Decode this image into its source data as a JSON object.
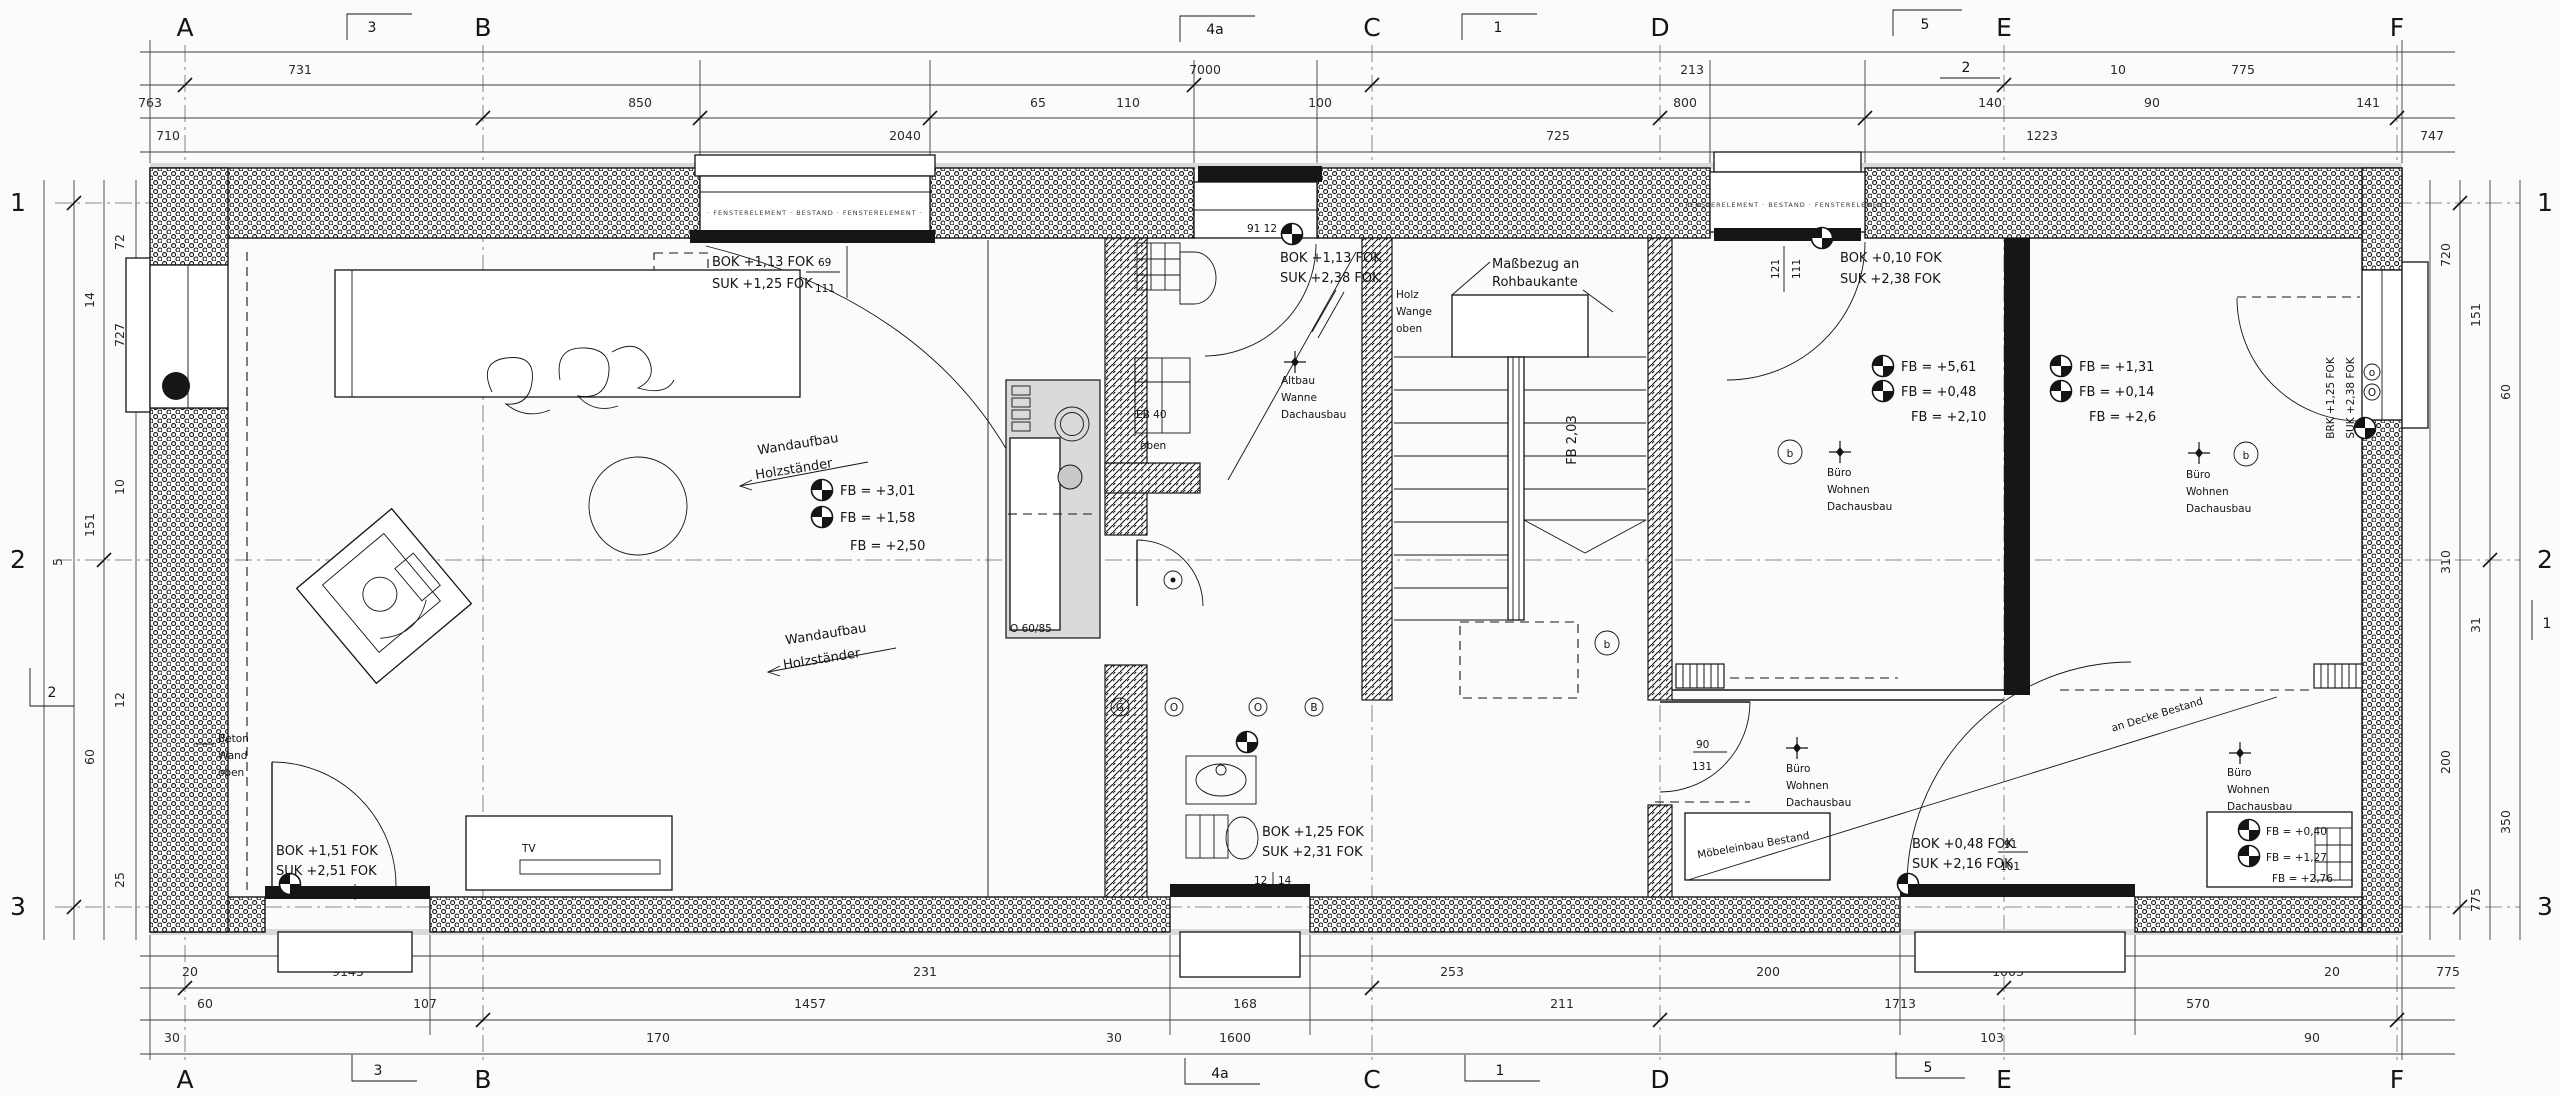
{
  "grid": {
    "cols": [
      "A",
      "B",
      "C",
      "D",
      "E",
      "F"
    ],
    "rows": [
      "1",
      "2",
      "3"
    ]
  },
  "flags": {
    "a": "3",
    "b": "4a",
    "c": "1",
    "d": "5",
    "e": "2",
    "left": "2",
    "right": "1"
  },
  "dims": {
    "top_a": [
      "731",
      "7000",
      "213",
      "10",
      "775"
    ],
    "top_b": [
      "763",
      "850",
      "65",
      "110",
      "100",
      "800",
      "140",
      "90",
      "141"
    ],
    "top_c": [
      "710",
      "2040",
      "725",
      "1223",
      "747"
    ],
    "bot_a": [
      "20",
      "9145",
      "231",
      "253",
      "200",
      "1003",
      "20",
      "775"
    ],
    "bot_b": [
      "60",
      "107",
      "1457",
      "168",
      "211",
      "1713",
      "570"
    ],
    "bot_c": [
      "30",
      "170",
      "30",
      "1600",
      "103",
      "90"
    ],
    "left": [
      "72",
      "14",
      "727",
      "10",
      "151",
      "5",
      "12",
      "60",
      "25"
    ],
    "right": [
      "720",
      "151",
      "60",
      "310",
      "31",
      "200",
      "350",
      "775"
    ]
  },
  "window_band": "· FENSTERELEMENT · BESTAND · FENSTERELEMENT ·",
  "living": {
    "beton": [
      "Beton",
      "Wand",
      "oben"
    ],
    "win_label": [
      "BOK +1,13 FOK",
      "SUK +1,25 FOK"
    ],
    "win_dim": [
      "69",
      "111"
    ],
    "note1": [
      "Wandaufbau",
      "Holzständer"
    ],
    "note2": [
      "Wandaufbau",
      "Holzständer"
    ],
    "fb": [
      "FB = +3,01",
      "FB = +1,58",
      "FB = +2,50"
    ],
    "door_label": [
      "BOK +1,51 FOK",
      "SUK +2,51 FOK"
    ],
    "door_dim": [
      "12",
      "14"
    ],
    "tv": "TV"
  },
  "kitchen": {
    "counter": "O 60/85"
  },
  "bath": {
    "win_dim": "91 12",
    "elev": [
      "BOK +1,13 FOK",
      "SUK +2,38 FOK"
    ],
    "note": [
      "Altbau",
      "Wanne",
      "Dachausbau"
    ],
    "basin": [
      "EB 40",
      "oben"
    ],
    "wc_marks": [
      "G",
      "O",
      "O",
      "B"
    ],
    "wc_label": [
      "BOK +1,25 FOK",
      "SUK +2,31 FOK"
    ],
    "wc_dim": [
      "12",
      "14"
    ]
  },
  "stairs": {
    "note": [
      "Maßbezug an",
      "Rohbaukante"
    ],
    "side": [
      "Holz",
      "Wange",
      "oben"
    ],
    "run": "FB 2,03",
    "mark": "b"
  },
  "bed1": {
    "win_label": [
      "BOK +0,10 FOK",
      "SUK +2,38 FOK"
    ],
    "win_dim": [
      "121",
      "111"
    ],
    "fb": [
      "FB = +5,61",
      "FB = +0,48",
      "FB = +2,10"
    ],
    "mark": "b",
    "note": [
      "Büro",
      "Wohnen",
      "Dachausbau"
    ]
  },
  "bed2": {
    "fb": [
      "FB = +1,31",
      "FB = +0,14",
      "FB = +2,6"
    ],
    "mark": "b",
    "note": [
      "Büro",
      "Wohnen",
      "Dachausbau"
    ],
    "wall_label": [
      "BRK +1,25 FOK",
      "SUK +2,38 FOK"
    ],
    "wall_marks": [
      "o",
      "O"
    ],
    "closet_fb": [
      "FB = +0,40",
      "FB = +1,27",
      "FB = +2,76"
    ],
    "corner_note": [
      "Büro",
      "Wohnen",
      "Dachausbau"
    ]
  },
  "corridor": {
    "door_dim": [
      "90",
      "131"
    ],
    "note": [
      "Büro",
      "Wohnen",
      "Dachausbau"
    ],
    "closet": "Möbeleinbau Bestand",
    "diag": "an Decke Bestand",
    "door_label": [
      "BOK +0,48 FOK",
      "SUK +2,16 FOK"
    ],
    "door_dim2": [
      "91",
      "101"
    ]
  }
}
